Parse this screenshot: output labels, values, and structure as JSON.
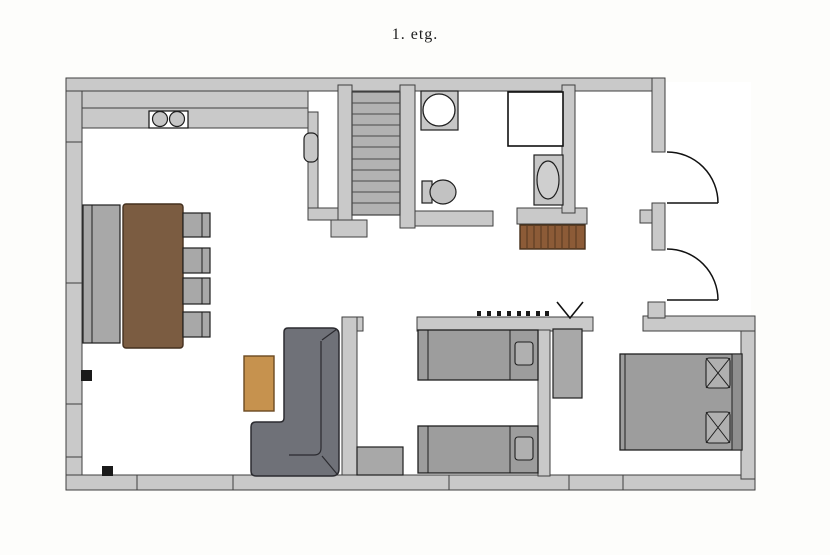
{
  "title": "1. etg.",
  "colors": {
    "page": "#fdfdfb",
    "floor": "#ffffff",
    "wall": "#c9c9c9",
    "wallStroke": "#3f3f3f",
    "stair": "#b2b2b2",
    "stairLine": "#4a4a4a",
    "gray": "#a8a8a8",
    "grayLight": "#c6c6c6",
    "bed": "#9d9d9d",
    "pillow": "#b0b0b0",
    "headboard": "#8f8f8f",
    "sofa": "#6f7178",
    "sofaStroke": "#2b2b30",
    "wood": "#7b5c41",
    "woodStroke": "#44301f",
    "coffee": "#c6924e",
    "coffeeStroke": "#6b4a22",
    "bench": "#8c5b37",
    "benchStroke": "#462f1a",
    "black": "#1a1a1a",
    "outline": "#1f1f1f"
  },
  "objects": [
    "staircase",
    "washing-machine",
    "shower-cabin",
    "toilet",
    "washbasin",
    "hall-bench",
    "coat-hooks",
    "v-mark",
    "kitchen-counter",
    "double-sink",
    "kitchen-island",
    "dining-table",
    "dining-chairs",
    "coffee-table",
    "corner-sofa",
    "single-bed",
    "single-bed",
    "dresser",
    "wardrobe",
    "double-bed",
    "entry-door",
    "entry-door"
  ]
}
